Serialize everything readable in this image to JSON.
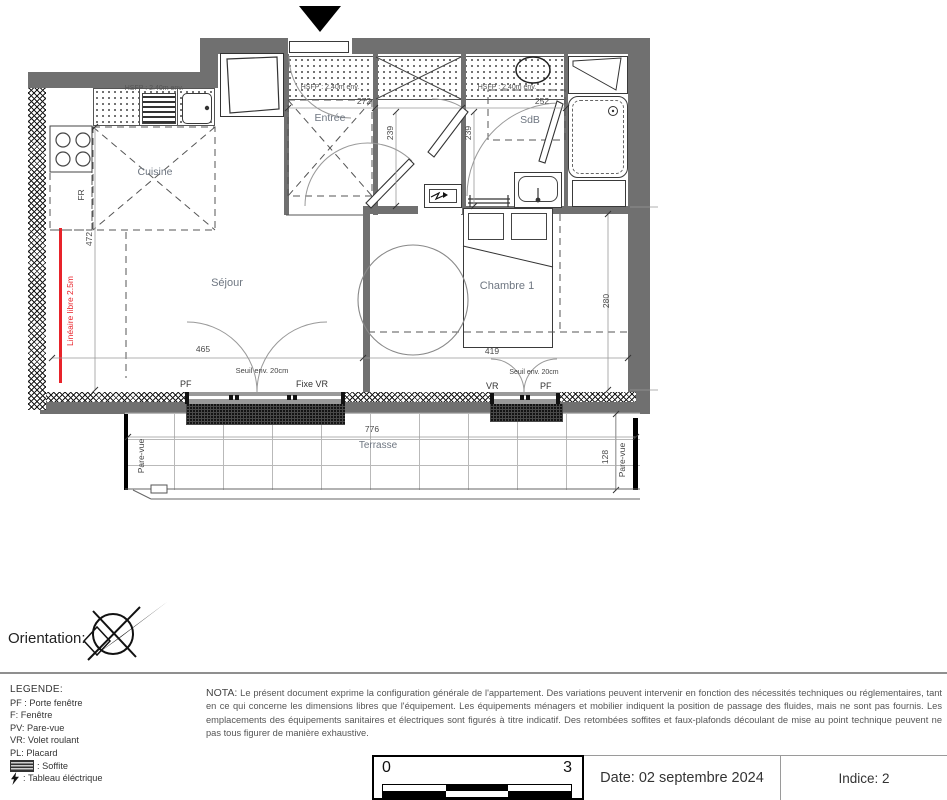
{
  "plan": {
    "rooms": {
      "cuisine": "Cuisine",
      "entree": "Entrée",
      "sdb": "SdB",
      "sejour": "Séjour",
      "chambre": "Chambre 1",
      "terrasse": "Terrasse"
    },
    "dims": {
      "entree_w": "272",
      "hall_d": "239",
      "sdb_w": "252",
      "kitchen_h": "472",
      "chambre_h": "280",
      "sejour_w": "465",
      "chambre_w": "419",
      "terrasse_w": "776",
      "terrasse_d": "128"
    },
    "labels": {
      "hsfp": "HSFP : 2.40m env.",
      "seuil": "Seuil env. 20cm",
      "lineaire": "Linéaire libre 2.5m",
      "fr": "FR",
      "pf": "PF",
      "fixe_vr": "Fixe  VR",
      "vr": "VR",
      "pare_vue": "Pare-vue"
    }
  },
  "orientation": {
    "label": "Orientation:"
  },
  "legend": {
    "title": "LEGENDE:",
    "items": [
      "PF : Porte fenêtre",
      "F: Fenêtre",
      "PV: Pare-vue",
      "VR: Volet roulant",
      "PL: Placard",
      ": Soffite",
      ": Tableau éléctrique"
    ]
  },
  "nota": {
    "label": "NOTA:",
    "text": "Le présent document exprime la configuration générale de l'appartement. Des variations peuvent intervenir en fonction des nécessités techniques ou réglementaires, tant en ce qui concerne les dimensions libres que l'équipement. Les équipements ménagers et mobilier indiquent la position de passage des fluides, mais ne sont pas fournis. Les emplacements des équipements sanitaires et électriques sont figurés à titre indicatif. Des retombées soffites et faux-plafonds découlant de mise au point technique peuvent ne pas tous figurer de manière exhaustive."
  },
  "footer": {
    "scale_start": "0",
    "scale_end": "3",
    "date": "Date: 02 septembre 2024",
    "indice": "Indice: 2"
  }
}
